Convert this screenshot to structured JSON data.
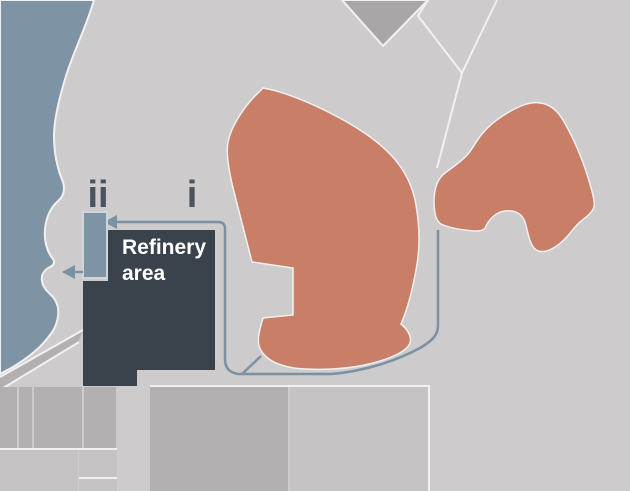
{
  "map": {
    "markers": {
      "pier_marker": "ii",
      "site_marker": "i"
    },
    "refinery": {
      "label_line1": "Refinery",
      "label_line2": "area"
    },
    "colors": {
      "land": "#cdcbcc",
      "water": "#7e93a3",
      "zone_fill": "#c87e67",
      "refinery_block": "#3a434c",
      "pier_fill": "#7e94a5",
      "pier_border": "#cdd6dd",
      "route_line": "#7b90a1",
      "road_line": "#f2f1f2",
      "block_fill": "#b3b0b2",
      "block_fill_light": "#c5c3c4",
      "hill_fill": "#a9a6a8",
      "marker_text": "#49545e",
      "refinery_text": "#ffffff"
    }
  }
}
